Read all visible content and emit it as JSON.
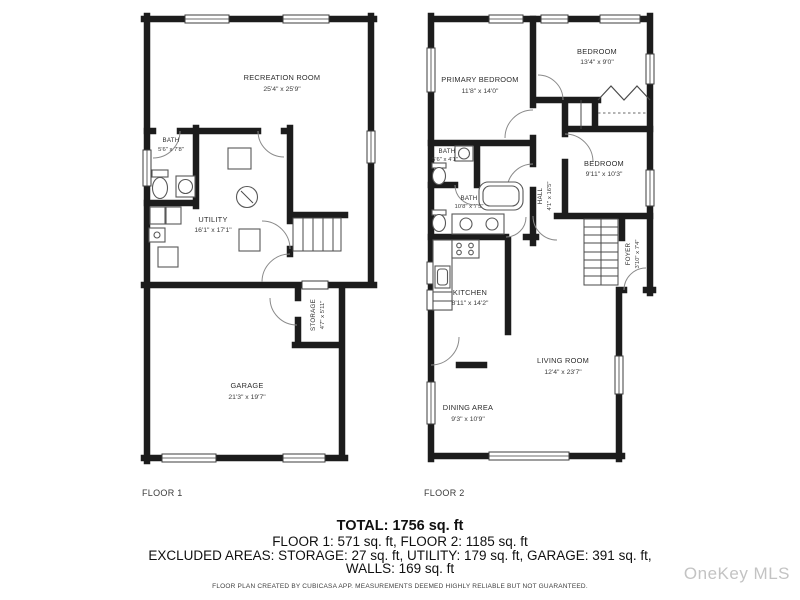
{
  "floor1": {
    "label": "FLOOR 1",
    "recreation": {
      "name": "RECREATION ROOM",
      "dims": "25'4\" x 25'9\""
    },
    "bath": {
      "name": "BATH",
      "dims": "5'6\" x 7'8\""
    },
    "utility": {
      "name": "UTILITY",
      "dims": "16'1\" x 17'1\""
    },
    "storage": {
      "name": "STORAGE",
      "dims": "4'7\" x 5'11\""
    },
    "garage": {
      "name": "GARAGE",
      "dims": "21'3\" x 19'7\""
    }
  },
  "floor2": {
    "label": "FLOOR 2",
    "primary_bedroom": {
      "name": "PRIMARY BEDROOM",
      "dims": "11'8\" x 14'0\""
    },
    "bedroom_top": {
      "name": "BEDROOM",
      "dims": "13'4\" x 9'0\""
    },
    "bath_small": {
      "name": "BATH",
      "dims": "5'6\" x 4'1\""
    },
    "bath_main": {
      "name": "BATH",
      "dims": "10'8\" x 7'5\""
    },
    "hall": {
      "name": "HALL",
      "dims": "4'1\" x 16'5\""
    },
    "bedroom_right": {
      "name": "BEDROOM",
      "dims": "9'11\" x 10'3\""
    },
    "kitchen": {
      "name": "KITCHEN",
      "dims": "8'11\" x 14'2\""
    },
    "foyer": {
      "name": "FOYER",
      "dims": "3'10\" x 7'4\""
    },
    "living_room": {
      "name": "LIVING ROOM",
      "dims": "12'4\" x 23'7\""
    },
    "dining_area": {
      "name": "DINING AREA",
      "dims": "9'3\" x 10'9\""
    }
  },
  "summary": {
    "total": "TOTAL: 1756 sq. ft",
    "floors": "FLOOR 1: 571 sq. ft, FLOOR 2: 1185 sq. ft",
    "excluded": "EXCLUDED AREAS: STORAGE: 27 sq. ft, UTILITY: 179 sq. ft, GARAGE: 391 sq. ft,",
    "walls": "WALLS: 169 sq. ft",
    "disclaimer": "FLOOR PLAN CREATED BY CUBICASA APP. MEASUREMENTS DEEMED HIGHLY RELIABLE BUT NOT GUARANTEED."
  },
  "watermark": "OneKey MLS",
  "colors": {
    "wall": "#1c1c1c",
    "text": "#2d2d2d",
    "watermark": "#c3c3c3"
  }
}
